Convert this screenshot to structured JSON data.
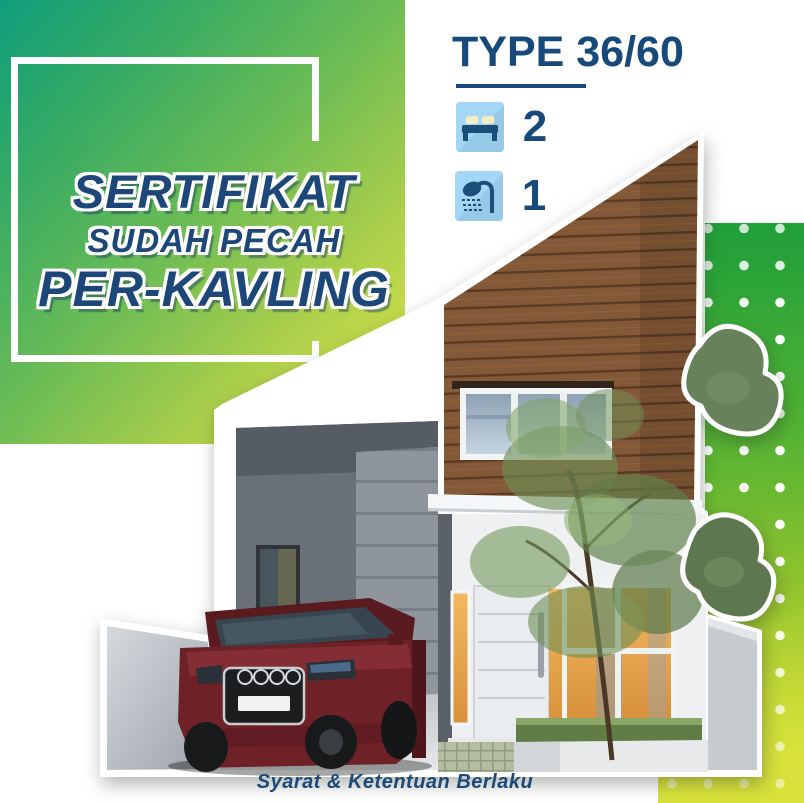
{
  "headline": {
    "line1": "SERTIFIKAT",
    "line2": "SUDAH PECAH",
    "line3": "PER-KAVLING"
  },
  "type_header": {
    "label": "TYPE 36/60"
  },
  "specs": {
    "bedrooms": {
      "icon": "bed-icon",
      "count": "2"
    },
    "bathrooms": {
      "icon": "shower-icon",
      "count": "1"
    }
  },
  "footer": {
    "note": "Syarat & Ketentuan Berlaku"
  },
  "colors": {
    "navy": "#17497b",
    "headline_navy": "#1d4778",
    "tile_blue": "#a4d6f5",
    "green_gradient_start": "#0f9e7c",
    "green_gradient_end": "#d9e54b",
    "dot_panel_green": "#1f9f3a",
    "wood_brown": "#845937",
    "car_maroon": "#6e2127"
  },
  "house": {
    "description": "two-story modern house render with wood facade, carport and maroon SUV",
    "license_plate": ""
  }
}
